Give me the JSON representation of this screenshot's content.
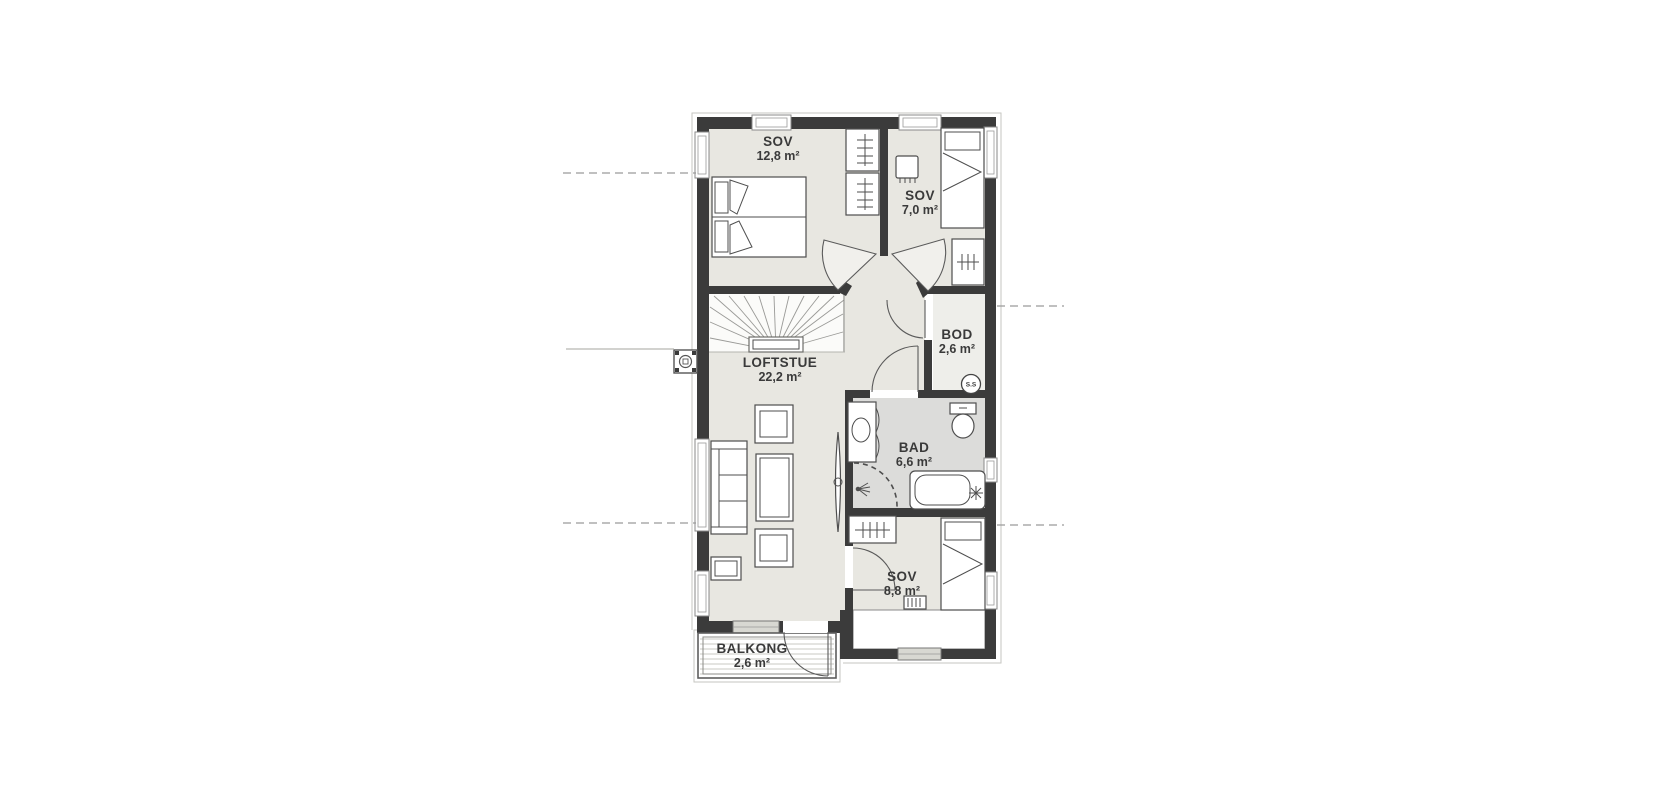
{
  "plan": {
    "rooms": [
      {
        "name": "SOV",
        "area": "12,8 m²"
      },
      {
        "name": "SOV",
        "area": "7,0 m²"
      },
      {
        "name": "LOFTSTUE",
        "area": "22,2 m²"
      },
      {
        "name": "BOD",
        "area": "2,6 m²"
      },
      {
        "name": "BAD",
        "area": "6,6 m²"
      },
      {
        "name": "SOV",
        "area": "8,8 m²"
      },
      {
        "name": "BALKONG",
        "area": "2,6 m²"
      }
    ],
    "badges": {
      "shaft": "S.S"
    },
    "colors": {
      "wall": "#3b3b3b",
      "floor": "#e8e7e1",
      "bathroom_floor": "#dcdcda",
      "storage_floor": "#eeeeea",
      "stair_floor": "#fbfbf9",
      "background": "#ffffff"
    }
  }
}
